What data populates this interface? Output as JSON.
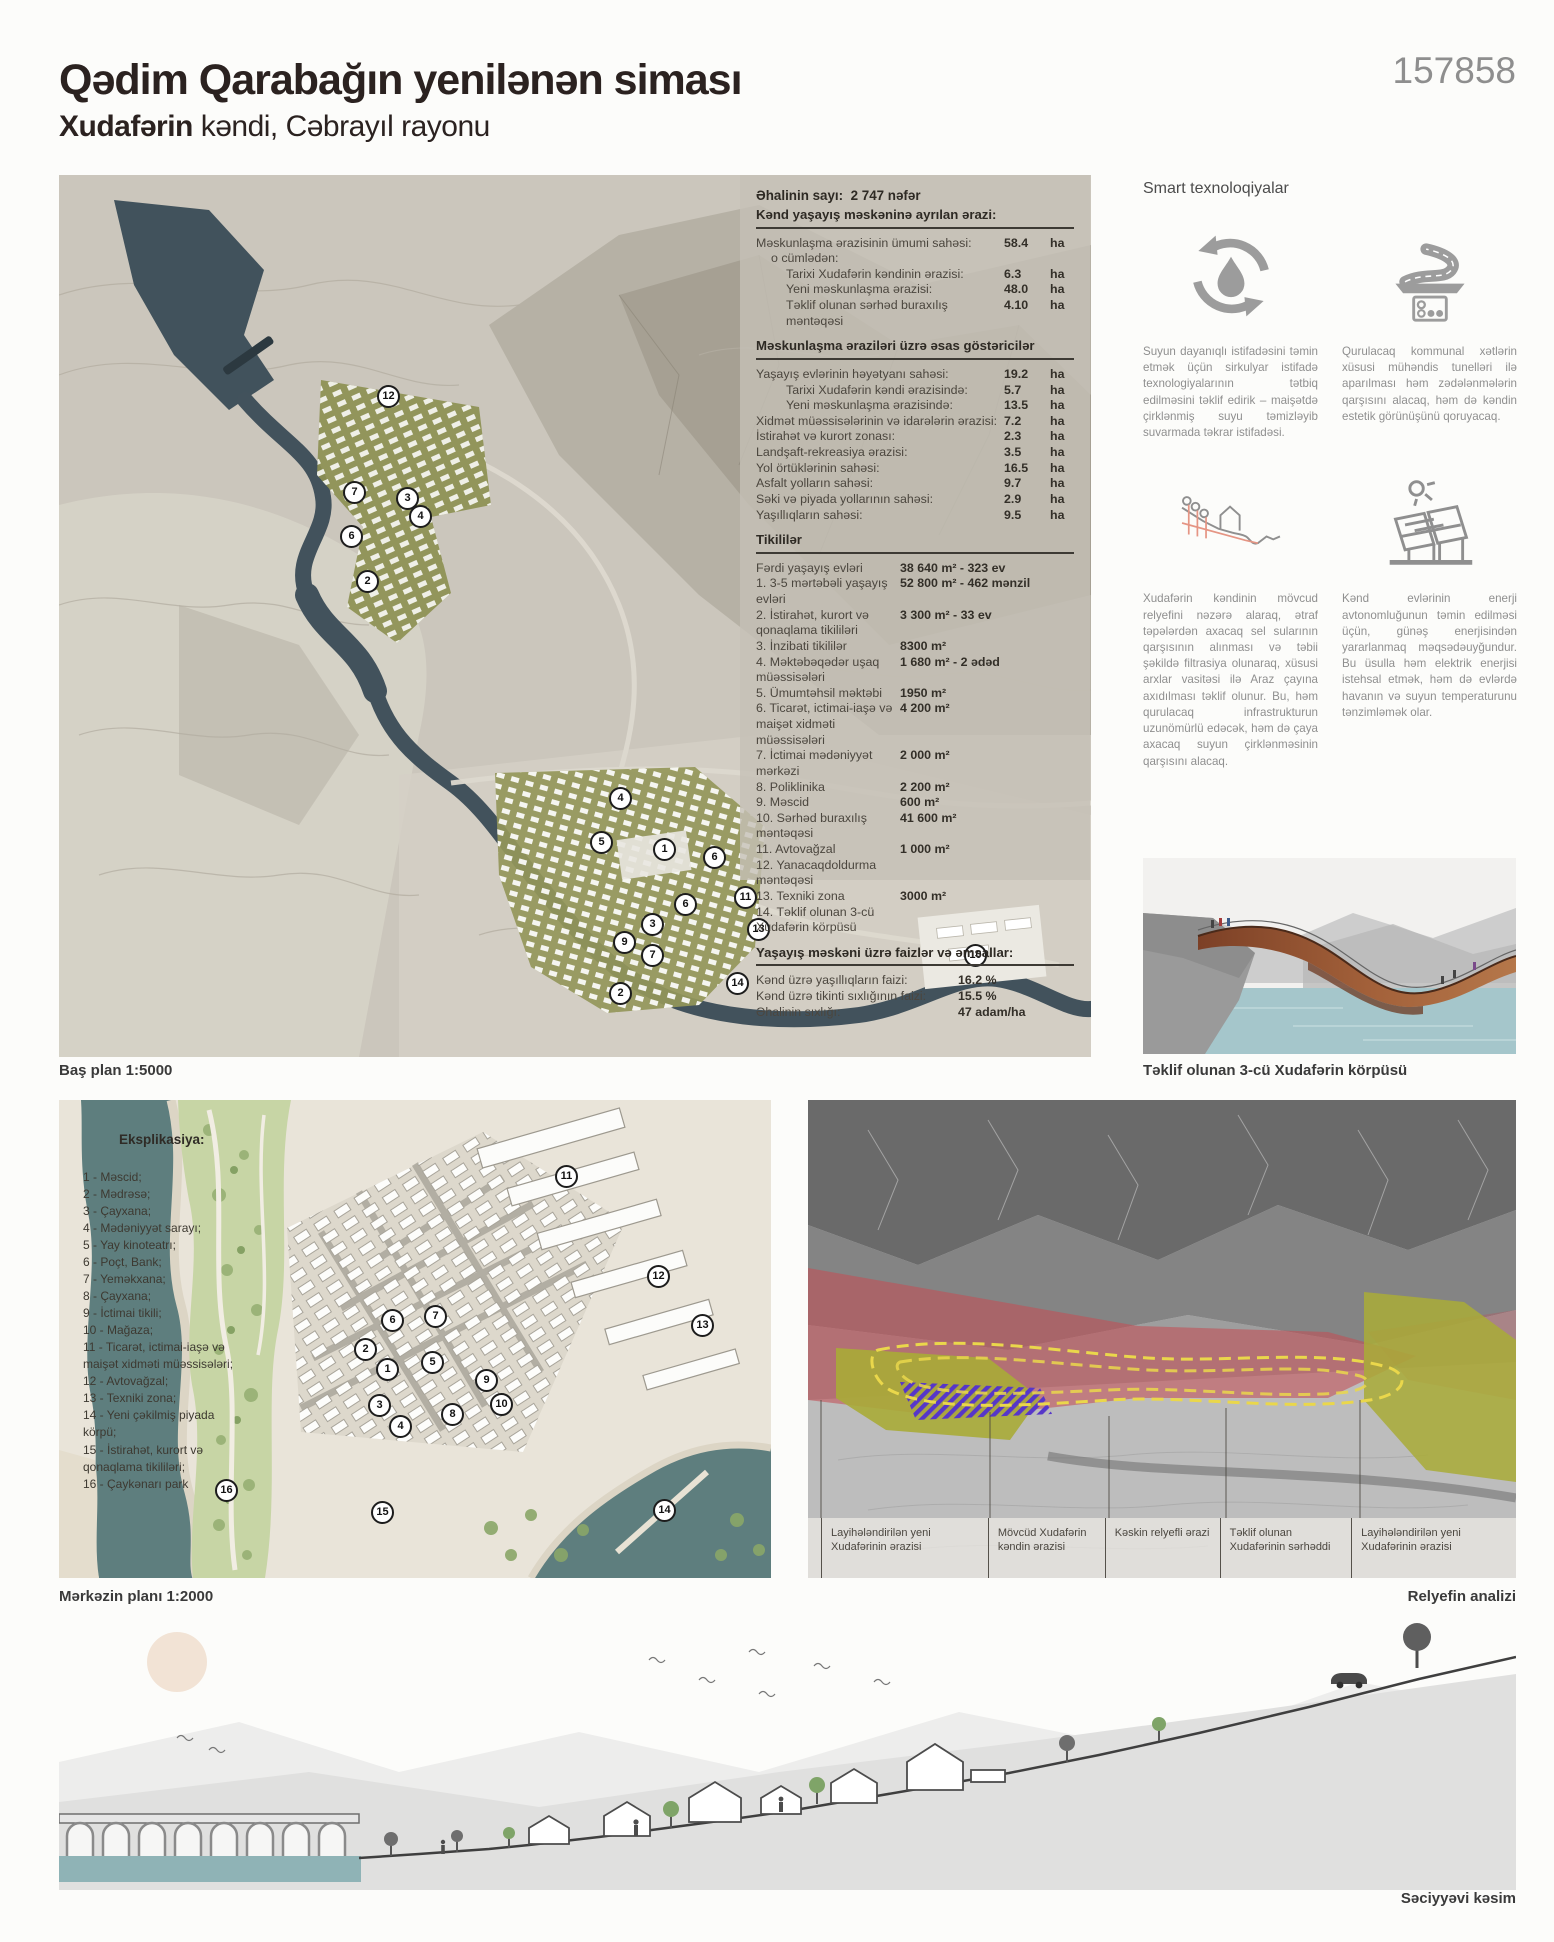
{
  "header": {
    "title": "Qədim Qarabağın yenilənən siması",
    "subtitle_bold": "Xudafərin",
    "subtitle_rest": " kəndi, Cəbrayıl rayonu",
    "board_number": "157858"
  },
  "stats": {
    "population": {
      "label": "Əhalinin sayı:",
      "value": "2 747 nəfər"
    },
    "sections": [
      {
        "title": "Kənd yaşayış məskəninə ayrılan ərazi:",
        "vw": 46,
        "rows": [
          {
            "label": "Məskunlaşma ərazisinin ümumi sahəsi:",
            "value": "58.4",
            "unit": "ha",
            "indent": 0
          },
          {
            "label": "o cümlədən:",
            "value": "",
            "unit": "",
            "indent": 1
          },
          {
            "label": "Tarixi Xudafərin kəndinin ərazisi:",
            "value": "6.3",
            "unit": "ha",
            "indent": 2
          },
          {
            "label": "Yeni məskunlaşma ərazisi:",
            "value": "48.0",
            "unit": "ha",
            "indent": 2
          },
          {
            "label": "Təklif olunan sərhəd buraxılış məntəqəsi",
            "value": "4.10",
            "unit": "ha",
            "indent": 2
          }
        ]
      },
      {
        "title": "Məskunlaşma əraziləri üzrə əsas göstəricilər",
        "vw": 46,
        "rows": [
          {
            "label": "Yaşayış evlərinin həyətyanı sahəsi:",
            "value": "19.2",
            "unit": "ha",
            "indent": 0
          },
          {
            "label": "Tarixi Xudafərin kəndi ərazisində:",
            "value": "5.7",
            "unit": "ha",
            "indent": 2
          },
          {
            "label": "Yeni məskunlaşma ərazisində:",
            "value": "13.5",
            "unit": "ha",
            "indent": 2
          },
          {
            "label": "Xidmət müəssisələrinin və idarələrin ərazisi:",
            "value": "7.2",
            "unit": "ha",
            "indent": 0
          },
          {
            "label": "İstirahət və kurort zonası:",
            "value": "2.3",
            "unit": "ha",
            "indent": 0
          },
          {
            "label": "Landşaft-rekreasiya ərazisi:",
            "value": "3.5",
            "unit": "ha",
            "indent": 0
          },
          {
            "label": "Yol örtüklərinin sahəsi:",
            "value": "16.5",
            "unit": "ha",
            "indent": 0
          },
          {
            "label": "Asfalt yolların sahəsi:",
            "value": "9.7",
            "unit": "ha",
            "indent": 0
          },
          {
            "label": "Səki və piyada yollarının sahəsi:",
            "value": "2.9",
            "unit": "ha",
            "indent": 0
          },
          {
            "label": "Yaşıllıqların sahəsi:",
            "value": "9.5",
            "unit": "ha",
            "indent": 0
          }
        ]
      },
      {
        "title": "Tikililər",
        "vw": 150,
        "rows": [
          {
            "label": "Fərdi yaşayış evləri",
            "value": "38 640 m² - 323 ev",
            "unit": "",
            "indent": 0
          },
          {
            "label": "1. 3-5 mərtəbəli yaşayış evləri",
            "value": "52 800 m² - 462 mənzil",
            "unit": "",
            "indent": 0
          },
          {
            "label": "2. İstirahət, kurort və qonaqlama tikililəri",
            "value": "3 300 m² - 33 ev",
            "unit": "",
            "indent": 0
          },
          {
            "label": "3. İnzibati tikililər",
            "value": "8300 m²",
            "unit": "",
            "indent": 0
          },
          {
            "label": "4. Məktəbəqədər uşaq müəssisələri",
            "value": "1 680 m² - 2 ədəd",
            "unit": "",
            "indent": 0
          },
          {
            "label": "5. Ümumtəhsil məktəbi",
            "value": "1950 m²",
            "unit": "",
            "indent": 0
          },
          {
            "label": "6. Ticarət, ictimai-iaşə və maişət xidməti müəssisələri",
            "value": "4 200 m²",
            "unit": "",
            "indent": 0
          },
          {
            "label": "7. İctimai mədəniyyət mərkəzi",
            "value": "2 000 m²",
            "unit": "",
            "indent": 0
          },
          {
            "label": "8. Poliklinika",
            "value": "2 200 m²",
            "unit": "",
            "indent": 0
          },
          {
            "label": "9. Məscid",
            "value": "600 m²",
            "unit": "",
            "indent": 0
          },
          {
            "label": "10. Sərhəd buraxılış məntəqəsi",
            "value": "41 600 m²",
            "unit": "",
            "indent": 0
          },
          {
            "label": "11. Avtovağzal",
            "value": "1 000 m²",
            "unit": "",
            "indent": 0
          },
          {
            "label": "12. Yanacaqdoldurma məntəqəsi",
            "value": "",
            "unit": "",
            "indent": 0
          },
          {
            "label": "13. Texniki zona",
            "value": "3000 m²",
            "unit": "",
            "indent": 0
          },
          {
            "label": "14. Təklif olunan 3-cü Xudafərin körpüsü",
            "value": "",
            "unit": "",
            "indent": 0
          }
        ]
      },
      {
        "title": "Yaşayış məskəni üzrə faizlər və əmsallar:",
        "vw": 92,
        "rows": [
          {
            "label": "Kənd üzrə yaşıllıqların faizi:",
            "value": "16.2 %",
            "unit": "",
            "indent": 0
          },
          {
            "label": "Kənd üzrə tikinti sıxlığının faizi:",
            "value": "15.5 %",
            "unit": "",
            "indent": 0
          },
          {
            "label": "Əhalinin sıxlığı:",
            "value": "47 adam/ha",
            "unit": "",
            "indent": 0
          }
        ]
      }
    ]
  },
  "smart": {
    "title": "Smart texnoloqiyalar",
    "items": [
      {
        "icon": "water-recycle-icon",
        "text": "Suyun dayanıqlı istifadəsini təmin etmək üçün sirkulyar istifadə texnologiyalarının tətbiq edilməsini təklif edirik – maişətdə çirklənmiş suyu təmizləyib suvarmada təkrar istifadəsi."
      },
      {
        "icon": "road-utility-tunnel-icon",
        "text": "Qurulacaq kommunal xətlərin xüsusi mühəndis tunelləri ilə aparılması həm zədələnmələrin qarşısını alacaq, həm də kəndin estetik görünüşünü qoruyacaq."
      },
      {
        "icon": "terrain-drainage-icon",
        "text": "Xudafərin kəndinin mövcud relyefini nəzərə alaraq, ətraf təpələrdən axacaq sel sularının qarşısının alınması və təbii şəkildə filtrasiya olunaraq, xüsusi arxlar vasitəsi ilə Araz çayına axıdılması təklif olunur. Bu, həm qurulacaq infrastrukturun uzunömürlü edəcək, həm də çaya axacaq suyun çirklənməsinin qarşısını alacaq."
      },
      {
        "icon": "solar-panel-icon",
        "text": "Kənd evlərinin enerji avtonomluğunun təmin edilməsi üçün, günəş enerjisindən yararlanmaq məqsədəuyğundur. Bu üsulla həm elektrik enerjisi istehsal etmək, həm də evlərdə havanın və suyun temperaturunu tənzimləmək olar."
      }
    ]
  },
  "captions": {
    "master_plan": "Baş plan 1:5000",
    "bridge": "Təklif olunan 3-cü Xudafərin körpüsü",
    "central_plan": "Mərkəzin planı 1:2000",
    "relief": "Relyefin analizi",
    "section": "Səciyyəvi kəsim"
  },
  "master_plan": {
    "markers": [
      {
        "n": "12",
        "x": 329,
        "y": 221
      },
      {
        "n": "7",
        "x": 295,
        "y": 317
      },
      {
        "n": "3",
        "x": 348,
        "y": 323
      },
      {
        "n": "4",
        "x": 361,
        "y": 341
      },
      {
        "n": "6",
        "x": 292,
        "y": 361
      },
      {
        "n": "2",
        "x": 308,
        "y": 406
      },
      {
        "n": "4",
        "x": 561,
        "y": 623
      },
      {
        "n": "5",
        "x": 542,
        "y": 667
      },
      {
        "n": "1",
        "x": 605,
        "y": 674
      },
      {
        "n": "6",
        "x": 655,
        "y": 682
      },
      {
        "n": "11",
        "x": 686,
        "y": 722
      },
      {
        "n": "6",
        "x": 626,
        "y": 729
      },
      {
        "n": "13",
        "x": 699,
        "y": 754
      },
      {
        "n": "3",
        "x": 593,
        "y": 749
      },
      {
        "n": "9",
        "x": 565,
        "y": 767
      },
      {
        "n": "7",
        "x": 593,
        "y": 780
      },
      {
        "n": "10",
        "x": 916,
        "y": 780
      },
      {
        "n": "2",
        "x": 561,
        "y": 818
      },
      {
        "n": "14",
        "x": 678,
        "y": 808
      }
    ]
  },
  "central_plan": {
    "eksplikasiya_title": "Eksplikasiya:",
    "eksplikasiya": [
      "1 - Məscid;",
      "2 - Mədrəsə;",
      "3 - Çayxana;",
      "4 - Mədəniyyət sarayı;",
      "5 - Yay kinoteatrı;",
      "6 - Poçt, Bank;",
      "7 - Yeməkxana;",
      "8 - Çayxana;",
      "9 - İctimai tikili;",
      "10 - Mağaza;",
      "11 - Ticarət, ictimai-iaşə və maişət xidməti müəssisələri;",
      "12 - Avtovağzal;",
      "13 - Texniki zona;",
      "14 - Yeni çəkilmiş piyada körpü;",
      "15 - İstirahət, kurort və qonaqlama tikililəri;",
      "16 - Çaykənarı park"
    ],
    "markers": [
      {
        "n": "11",
        "x": 507,
        "y": 76
      },
      {
        "n": "12",
        "x": 599,
        "y": 176
      },
      {
        "n": "13",
        "x": 643,
        "y": 225
      },
      {
        "n": "6",
        "x": 333,
        "y": 220
      },
      {
        "n": "7",
        "x": 376,
        "y": 216
      },
      {
        "n": "2",
        "x": 306,
        "y": 249
      },
      {
        "n": "1",
        "x": 328,
        "y": 269
      },
      {
        "n": "5",
        "x": 373,
        "y": 262
      },
      {
        "n": "9",
        "x": 427,
        "y": 280
      },
      {
        "n": "10",
        "x": 442,
        "y": 304
      },
      {
        "n": "3",
        "x": 320,
        "y": 305
      },
      {
        "n": "8",
        "x": 393,
        "y": 314
      },
      {
        "n": "4",
        "x": 341,
        "y": 326
      },
      {
        "n": "16",
        "x": 167,
        "y": 390
      },
      {
        "n": "15",
        "x": 323,
        "y": 412
      },
      {
        "n": "14",
        "x": 605,
        "y": 410
      }
    ]
  },
  "relief": {
    "legend": [
      "Layihələndirilən yeni Xudafərinin ərazisi",
      "Mövcüd Xudafərin kəndin ərazisi",
      "Kəskin relyefli ərazi",
      "Təklif olunan Xudafərinin sərhəddi",
      "Layihələndirilən yeni Xudafərinin ərazisi"
    ]
  },
  "colors": {
    "river": "#42525c",
    "central_river": "#5e7e7e",
    "village_olive": "#8d9052",
    "relief_red": "#c24f57",
    "relief_olive": "#a9ab37",
    "relief_purple": "#5636c9",
    "boundary_yellow": "#ead74b",
    "bridge_copper": "#8a4a2f",
    "water_light": "#9dc2c8"
  }
}
